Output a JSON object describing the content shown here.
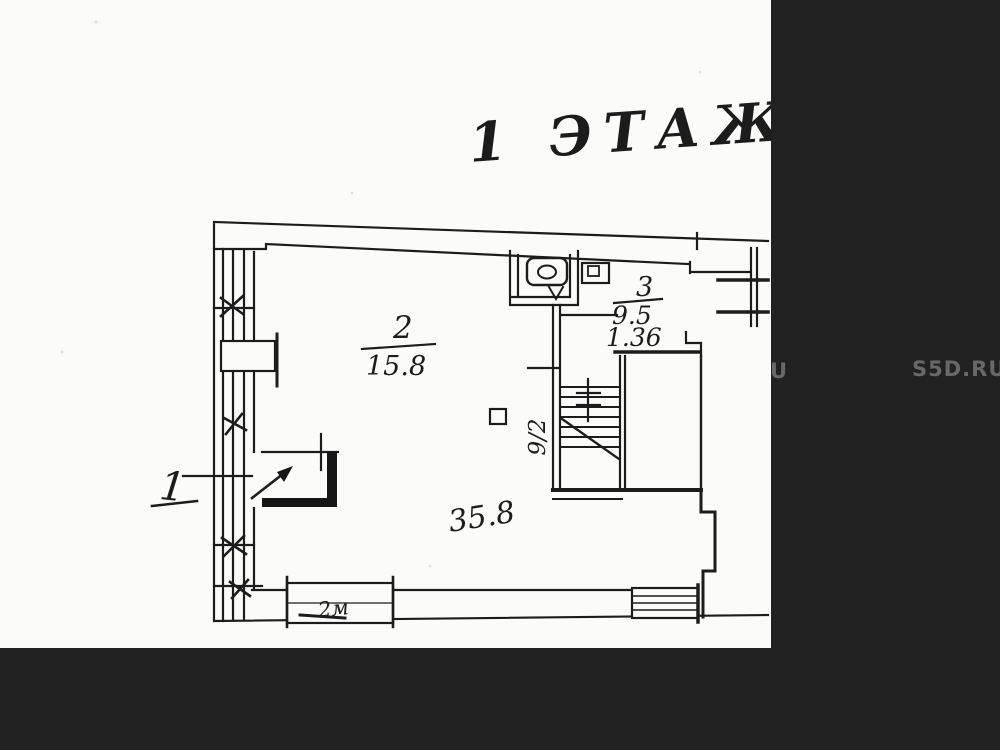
{
  "plan": {
    "floor_title": "1 ЭТАЖ",
    "rooms": [
      {
        "name": "room-1",
        "number": "1"
      },
      {
        "name": "room-2",
        "number": "2",
        "area": "15.8"
      },
      {
        "name": "room-3",
        "number": "3",
        "area": "9.5",
        "sub_area": "1.36"
      }
    ],
    "annotations": {
      "hall_area": "35.8",
      "stair_run": "9/2",
      "window_mark": "2м"
    }
  },
  "watermark": {
    "partial": "U",
    "site": "S5D.RU"
  },
  "colors": {
    "background": "#212121",
    "paper": "#fbfbfa",
    "ink": "#1e1e1e",
    "watermark": "#686868"
  }
}
